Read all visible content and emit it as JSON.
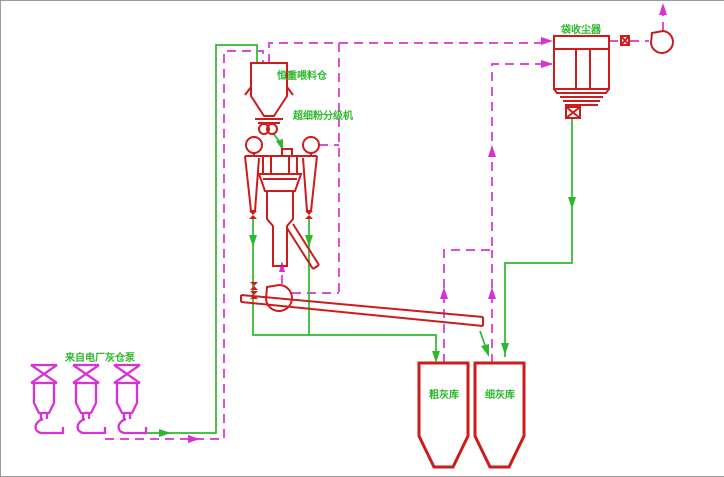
{
  "diagram": {
    "type": "process-flow-cad-drawing",
    "labels": {
      "feed_bin": "恒重喂料仓",
      "classifier": "超细粉分级机",
      "bag_filter": "袋收尘器",
      "source_pumps": "来自电厂灰仓泵",
      "coarse_silo": "粗灰库",
      "fine_silo": "细灰库"
    },
    "equipment_icons": [
      "feed-bin-hopper-icon",
      "rotary-feeder-icon",
      "classifier-mill-icon",
      "cyclone-icon",
      "circulating-fan-icon",
      "screw-conveyor-icon",
      "coarse-ash-silo-icon",
      "fine-ash-silo-icon",
      "bag-filter-icon",
      "exhaust-fan-icon",
      "bin-pump-icon"
    ]
  },
  "colors": {
    "equipment_red": "#cc1c1c",
    "pipe_magenta": "#d633d6",
    "pipe_green": "#2db92d",
    "label_green": "#2db92d",
    "background": "#ffffff"
  }
}
